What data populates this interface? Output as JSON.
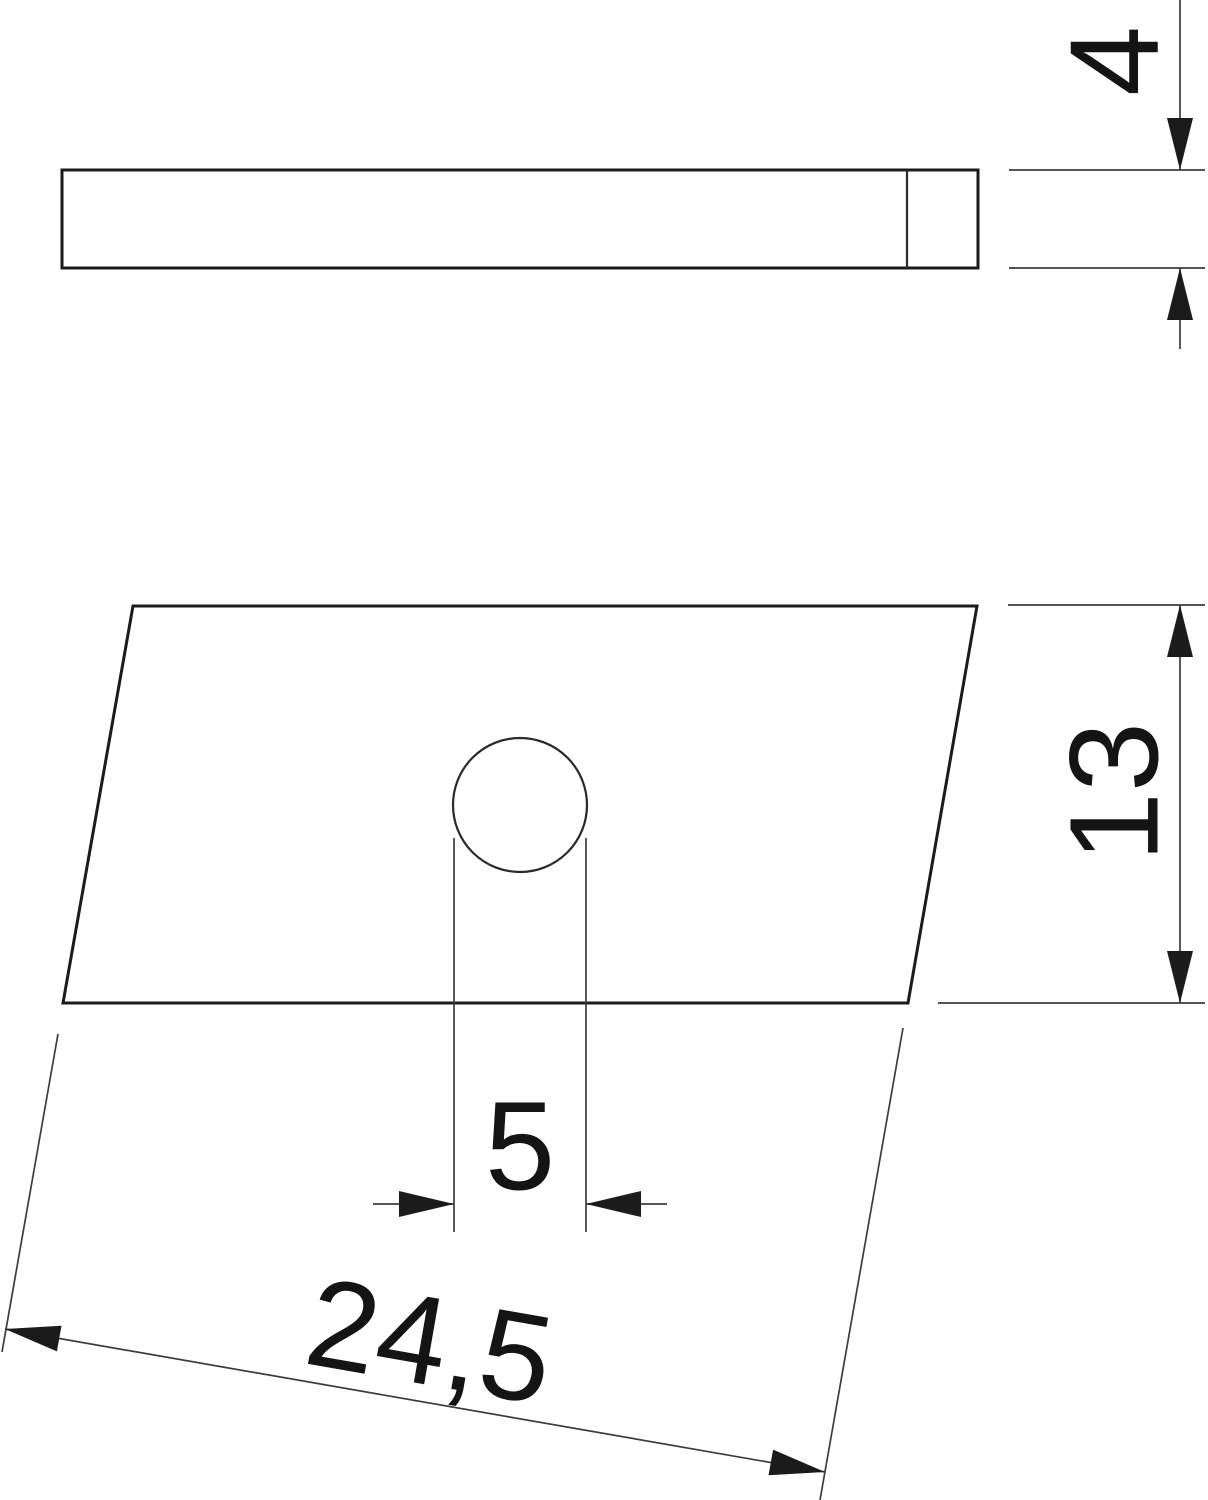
{
  "drawing": {
    "type": "technical-dimension-drawing",
    "views": {
      "side_view": "thin plate seen from the side",
      "plan_view": "sheared rectangular plate with round hole"
    },
    "dimensions": {
      "thickness": {
        "label": "4"
      },
      "height": {
        "label": "13"
      },
      "hole_diameter": {
        "label": "5"
      },
      "length": {
        "label": "24,5"
      }
    },
    "colors": {
      "outline": "#1b1b1b",
      "edge": "#2a2a2a",
      "thin_line": "#3d3d3d",
      "arrow": "#1b1b1b",
      "text": "#141414",
      "background": "#ffffff"
    }
  }
}
